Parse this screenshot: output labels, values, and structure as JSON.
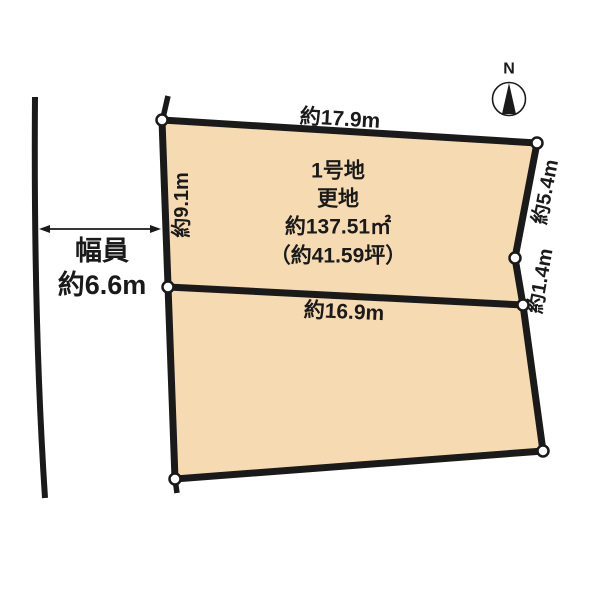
{
  "diagram": {
    "compass": {
      "north_label": "N"
    },
    "road": {
      "width_label_line1": "幅員",
      "width_label_line2": "約6.6m"
    },
    "lot": {
      "name": "1号地",
      "condition": "更地",
      "area_sqm": "約137.51㎡",
      "area_tsubo": "（約41.59坪）"
    },
    "dimensions": {
      "top_edge": "約17.9m",
      "left_edge": "約9.1m",
      "right_edge_upper": "約5.4m",
      "right_edge_middle": "約1.4m",
      "middle_edge": "約16.9m"
    },
    "colors": {
      "lot_fill": "#f6dbb2",
      "line": "#1a1a1a",
      "background": "#ffffff"
    }
  }
}
